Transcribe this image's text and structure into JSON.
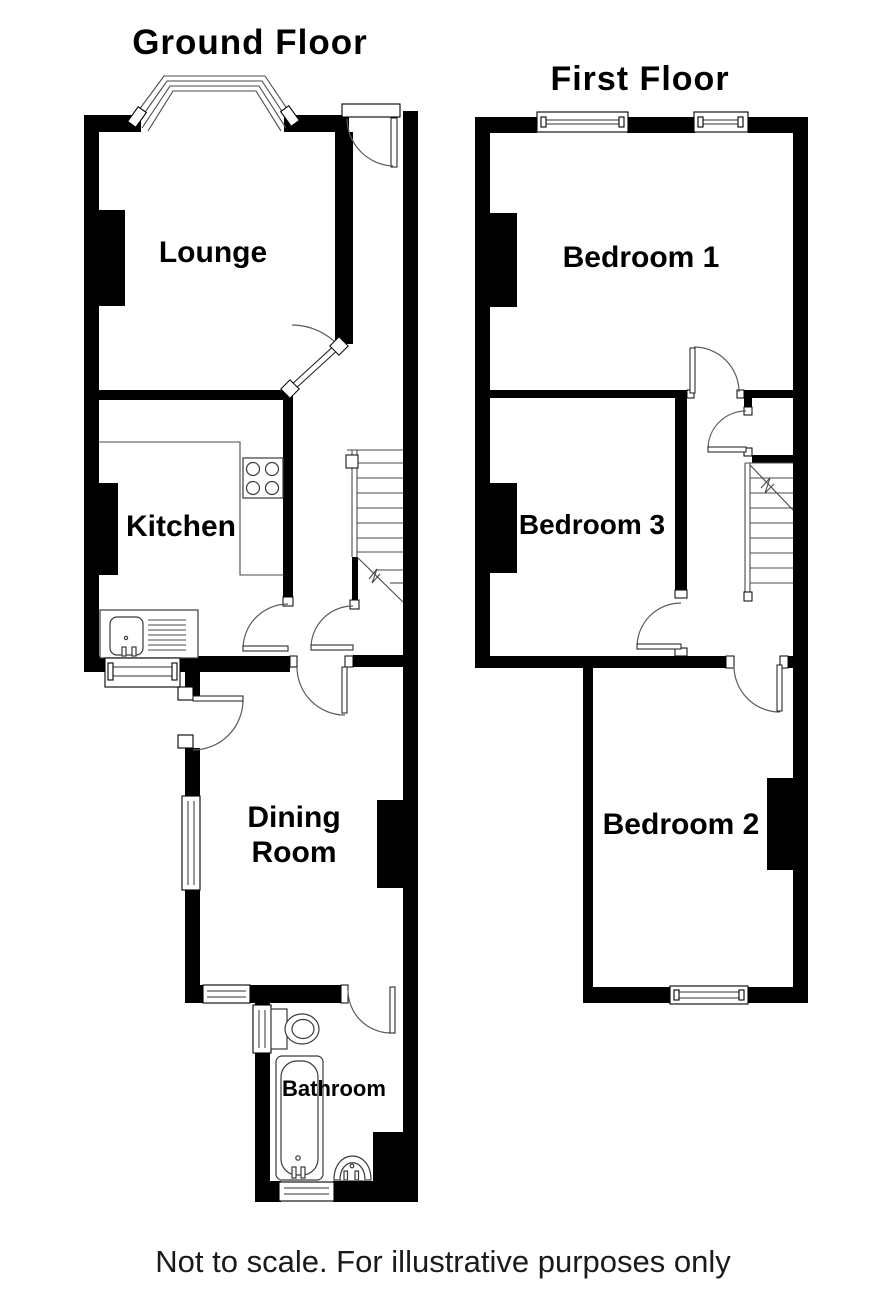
{
  "page": {
    "background_color": "#ffffff",
    "wall_color": "#000000",
    "line_color": "#4a4a4a",
    "text_color": "#000000"
  },
  "ground_floor": {
    "title": "Ground Floor",
    "rooms": {
      "lounge": "Lounge",
      "kitchen": "Kitchen",
      "dining_line1": "Dining",
      "dining_line2": "Room",
      "bathroom": "Bathroom"
    }
  },
  "first_floor": {
    "title": "First Floor",
    "rooms": {
      "bedroom1": "Bedroom 1",
      "bedroom2": "Bedroom 2",
      "bedroom3": "Bedroom 3"
    }
  },
  "footer": {
    "disclaimer": "Not to scale. For illustrative purposes only"
  }
}
